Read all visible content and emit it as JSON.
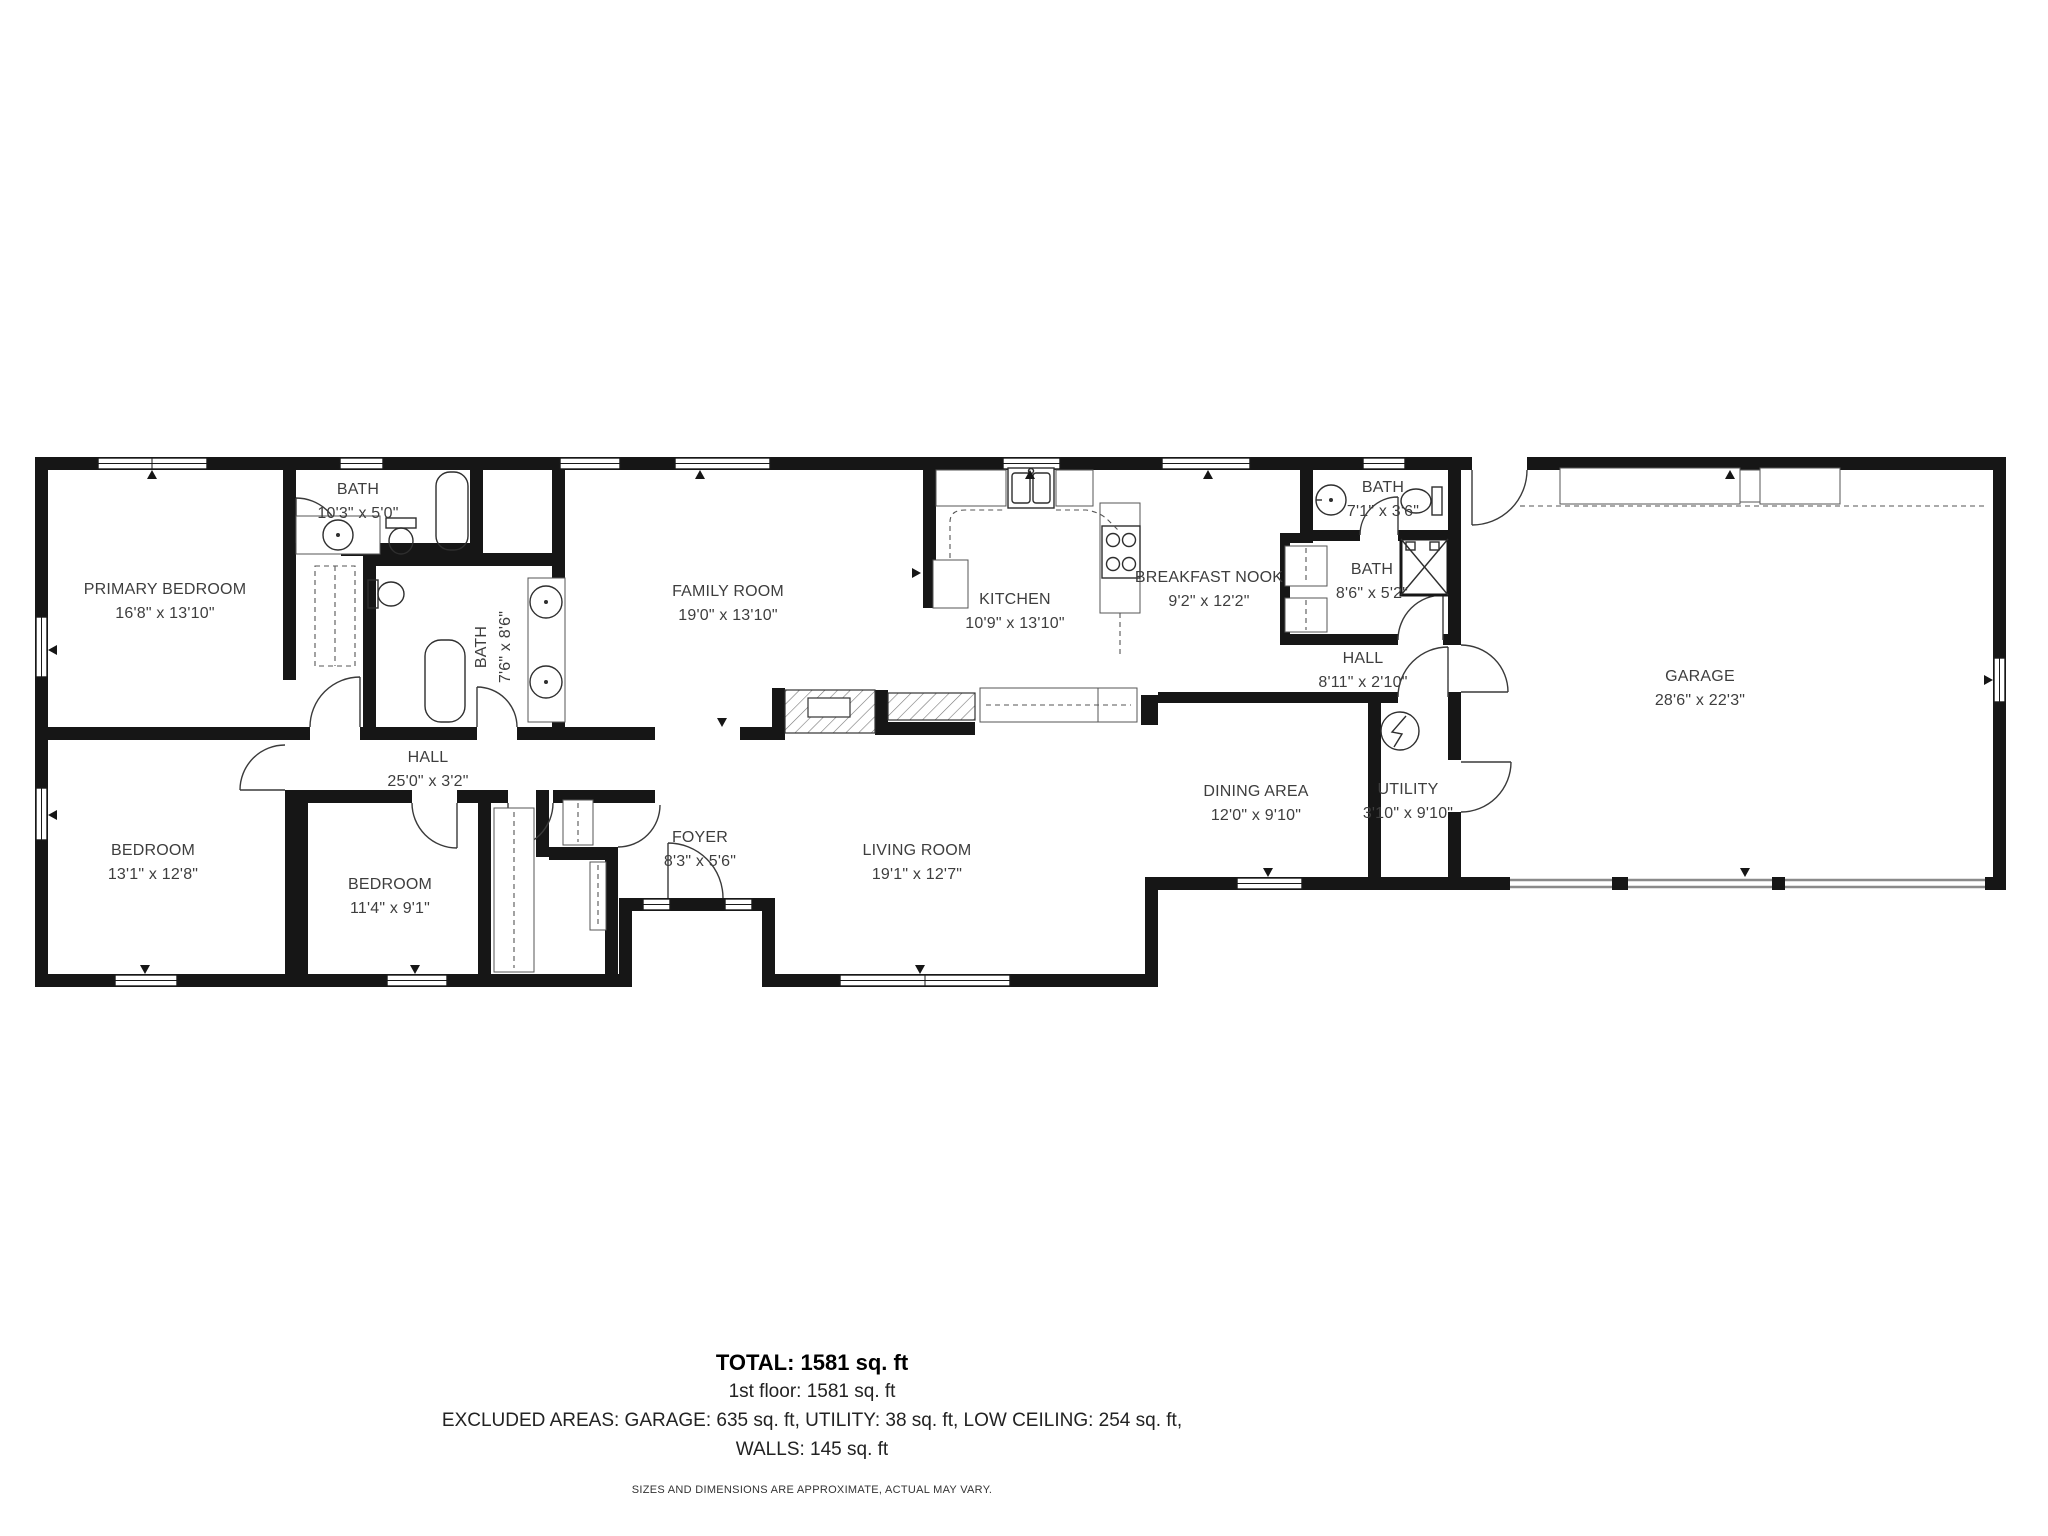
{
  "colors": {
    "wall": "#161616",
    "fixture": "#2e2e2e",
    "label": "#3e3e3e",
    "garage_door": "#8a8a8a"
  },
  "rooms": [
    {
      "id": "primary-bedroom",
      "name": "PRIMARY BEDROOM",
      "dims": "16'8\" x 13'10\""
    },
    {
      "id": "bath-1",
      "name": "BATH",
      "dims": "10'3\" x 5'0\""
    },
    {
      "id": "bath-2",
      "name": "BATH",
      "dims": "7'6\" x 8'6\""
    },
    {
      "id": "family-room",
      "name": "FAMILY ROOM",
      "dims": "19'0\" x 13'10\""
    },
    {
      "id": "kitchen",
      "name": "KITCHEN",
      "dims": "10'9\" x 13'10\""
    },
    {
      "id": "breakfast-nook",
      "name": "BREAKFAST NOOK",
      "dims": "9'2\" x 12'2\""
    },
    {
      "id": "bath-3",
      "name": "BATH",
      "dims": "7'1\" x 3'6\""
    },
    {
      "id": "bath-4",
      "name": "BATH",
      "dims": "8'6\" x 5'2\""
    },
    {
      "id": "hall-upper",
      "name": "HALL",
      "dims": "8'11\" x 2'10\""
    },
    {
      "id": "garage",
      "name": "GARAGE",
      "dims": "28'6\" x 22'3\""
    },
    {
      "id": "hall-main",
      "name": "HALL",
      "dims": "25'0\" x 3'2\""
    },
    {
      "id": "bedroom-1",
      "name": "BEDROOM",
      "dims": "13'1\" x 12'8\""
    },
    {
      "id": "bedroom-2",
      "name": "BEDROOM",
      "dims": "11'4\" x 9'1\""
    },
    {
      "id": "foyer",
      "name": "FOYER",
      "dims": "8'3\" x 5'6\""
    },
    {
      "id": "living-room",
      "name": "LIVING ROOM",
      "dims": "19'1\" x 12'7\""
    },
    {
      "id": "dining-area",
      "name": "DINING AREA",
      "dims": "12'0\" x 9'10\""
    },
    {
      "id": "utility",
      "name": "UTILITY",
      "dims": "3'10\" x 9'10\""
    }
  ],
  "footer": {
    "total": "TOTAL: 1581 sq. ft",
    "floor_line": "1st floor: 1581 sq. ft",
    "excluded_line": "EXCLUDED AREAS: GARAGE: 635 sq. ft, UTILITY: 38 sq. ft, LOW CEILING: 254 sq. ft,",
    "walls_line": "WALLS: 145 sq. ft",
    "disclaimer": "SIZES AND DIMENSIONS ARE APPROXIMATE, ACTUAL MAY VARY."
  }
}
